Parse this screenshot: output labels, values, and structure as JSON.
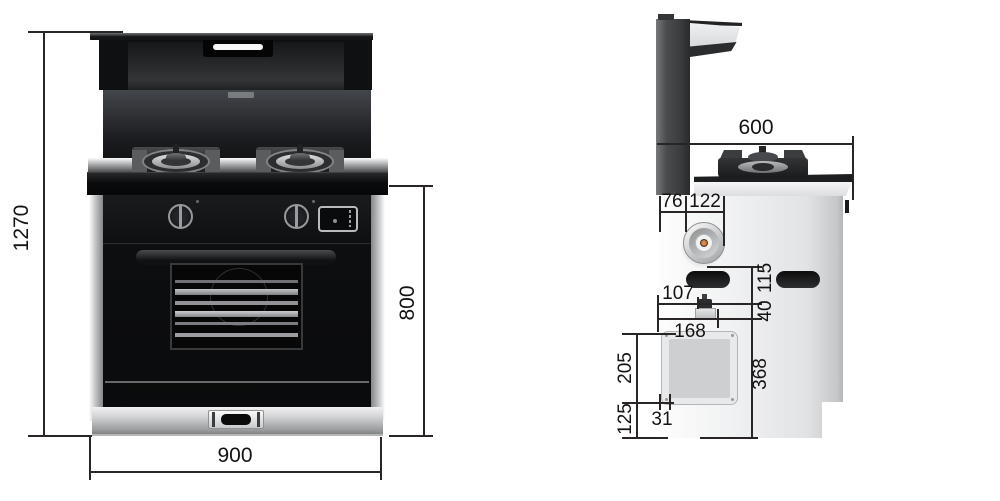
{
  "front_view": {
    "overall_height": "1270",
    "body_height": "800",
    "width": "900"
  },
  "side_view": {
    "top_depth": "600",
    "inlet_left_offset": "76",
    "inlet_span": "122",
    "valve_offset": "107",
    "cutout_width": "168",
    "panel_height": "205",
    "panel_bottom_offset": "125",
    "panel_edge_gap": "31",
    "lower_section_height": "368",
    "valve_drop": "40",
    "inlet_drop": "115"
  },
  "colors": {
    "background": "#ffffff",
    "dimension_line": "#292425",
    "appliance_black": "#121315",
    "stainless": "#c9cacc",
    "copper_fitting": "#b5763f"
  }
}
